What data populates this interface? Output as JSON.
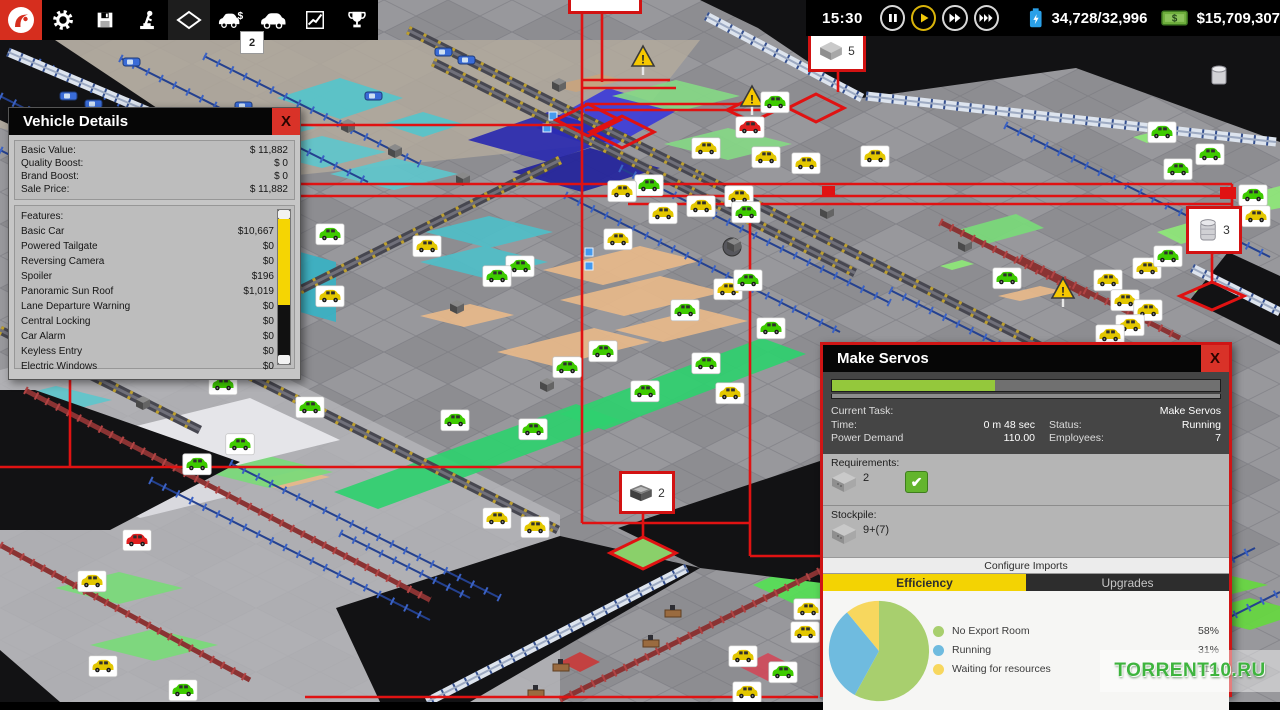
{
  "toolbar": {
    "icons": [
      "app-logo",
      "settings",
      "save",
      "research",
      "view-mode",
      "showroom",
      "vehicle-design",
      "stats",
      "achievements"
    ],
    "showroom_badge": "2",
    "time": "15:30",
    "resources": "34,728/32,996",
    "money": "$15,709,307"
  },
  "map": {
    "badge_counts": {
      "crate": "5",
      "barrel": "3",
      "machine": "2"
    },
    "zones": [
      {
        "p": "40,40 700,40 620,142 230,182 0,128 0,92",
        "c": "#b1a99c",
        "o": 0.85
      },
      {
        "p": "277,98 340,78 403,98 340,119",
        "c": "#55c4cb"
      },
      {
        "p": "383,124 423,112 463,124 423,137",
        "c": "#55c4cb"
      },
      {
        "p": "188,128 252,112 316,128 252,144",
        "c": "#5ec6cc"
      },
      {
        "p": "258,152 322,136 386,152 322,168",
        "c": "#5ec6cc"
      },
      {
        "p": "330,174 394,158 458,174 394,190",
        "c": "#5ec6cc"
      },
      {
        "p": "425,232 489,216 553,232 489,248",
        "c": "#4fbec8"
      },
      {
        "p": "420,262 484,246 548,262 484,278",
        "c": "#4fbec8"
      },
      {
        "p": "60,318 124,302 188,318 124,334",
        "c": "#5ec6cc"
      },
      {
        "p": "0,400 56,386 112,400 56,414",
        "c": "#5ec6cc"
      },
      {
        "p": "300,252 336,262 336,322 300,312",
        "c": "#38b2c4"
      },
      {
        "p": "536,128 608,88 678,110 606,150",
        "c": "#3c3cd8"
      },
      {
        "p": "468,140 548,112 628,134 548,162",
        "c": "#2a2ab0"
      },
      {
        "p": "512,172 590,148 660,168 582,192",
        "c": "#23239c"
      },
      {
        "p": "612,96 676,80 740,96 676,112",
        "c": "#86d886"
      },
      {
        "p": "664,144 728,128 792,144 728,160",
        "c": "#86d886"
      },
      {
        "p": "334,492 576,404 620,420 378,509",
        "c": "#2fd06f"
      },
      {
        "p": "560,414 762,338 806,354 604,430",
        "c": "#2fd06f"
      },
      {
        "p": "753,585 801,563 849,585 801,607",
        "c": "#55e055"
      },
      {
        "p": "543,270 640,246 700,261 603,285",
        "c": "#e7b98a"
      },
      {
        "p": "560,300 660,276 724,292 624,316",
        "c": "#e7b98a"
      },
      {
        "p": "497,352 594,328 650,342 553,366",
        "c": "#e7b98a"
      },
      {
        "p": "420,316 470,304 514,315 464,327",
        "c": "#e7b98a"
      },
      {
        "p": "615,330 700,309 748,321 663,342",
        "c": "#e7b98a"
      },
      {
        "p": "998,296 1040,286 1062,291 1020,301",
        "c": "#e7b98a"
      },
      {
        "p": "250,482 300,470 330,477 280,489",
        "c": "#e7b98a"
      },
      {
        "p": "552,86 600,74 624,80 576,92",
        "c": "#c8a47e"
      },
      {
        "p": "958,230 1016,214 1044,228 986,244",
        "c": "#7ada7a"
      },
      {
        "p": "1157,232 1205,218 1229,230 1181,244",
        "c": "#8ee878"
      },
      {
        "p": "1242,196 1280,186 1280,208 1258,212",
        "c": "#8ee878"
      },
      {
        "p": "1133,137 1161,130 1175,136 1147,143",
        "c": "#8ee878"
      },
      {
        "p": "940,266 962,260 974,264 952,270",
        "c": "#8ee878"
      },
      {
        "p": "1190,290 1240,272 1262,282 1212,300",
        "c": "#90ee60"
      },
      {
        "p": "1140,585 1204,569 1268,585 1204,601",
        "c": "#66d840"
      },
      {
        "p": "1186,614 1250,598 1280,606 1280,620 1250,630",
        "c": "#66d840"
      },
      {
        "p": "55,588 119,572 183,588 119,604",
        "c": "#7ada7a"
      },
      {
        "p": "90,645 154,629 218,645 154,661",
        "c": "#7ada7a"
      },
      {
        "p": "205,472 269,456 333,472 269,488",
        "c": "#7ada7a"
      },
      {
        "p": "120,430 250,398 340,440 210,472",
        "c": "#e9e9ee"
      },
      {
        "p": "60,484 150,462 230,496 140,518",
        "c": "#dcdce2"
      },
      {
        "p": "740,667 768,653 796,667 768,681",
        "c": "#cf4a5a"
      },
      {
        "p": "560,662 580,652 600,662 580,672",
        "c": "#c83b3b"
      }
    ],
    "darks": [
      "700,0 1280,0 1280,142 1076,68 862,98 758,28",
      "1228,252 1280,276 1280,345 1190,300",
      "336,608 560,536 700,568 470,702 380,702",
      "618,528 838,455 838,585 700,568",
      "0,390 35,390 240,462 110,530 0,530",
      "0,650 60,702 0,702",
      "0,40 55,40 160,110 60,148 0,120"
    ],
    "walls": [
      [
        687,
        568,
        427,
        702
      ],
      [
        866,
        96,
        1276,
        142
      ],
      [
        706,
        16,
        862,
        98
      ],
      [
        1192,
        268,
        1280,
        312
      ],
      [
        8,
        52,
        150,
        112
      ]
    ],
    "fences": [
      [
        38,
        62,
        286,
        186
      ],
      [
        120,
        58,
        368,
        182
      ],
      [
        204,
        56,
        420,
        164
      ],
      [
        0,
        150,
        180,
        240
      ],
      [
        0,
        96,
        120,
        156
      ],
      [
        565,
        195,
        840,
        332
      ],
      [
        620,
        168,
        890,
        303
      ],
      [
        150,
        480,
        430,
        620
      ],
      [
        230,
        463,
        500,
        598
      ],
      [
        845,
        690,
        1125,
        550
      ],
      [
        950,
        700,
        1255,
        548
      ],
      [
        1060,
        702,
        1280,
        592
      ],
      [
        890,
        290,
        1140,
        415
      ],
      [
        1005,
        125,
        1270,
        257
      ],
      [
        340,
        533,
        470,
        598
      ]
    ],
    "convs": [
      [
        408,
        30,
        700,
        176
      ],
      [
        700,
        176,
        1060,
        356
      ],
      [
        208,
        355,
        558,
        530
      ],
      [
        560,
        160,
        300,
        290
      ],
      [
        0,
        330,
        200,
        430
      ],
      [
        433,
        62,
        855,
        273
      ]
    ],
    "maroons": [
      [
        25,
        390,
        430,
        600
      ],
      [
        0,
        545,
        250,
        680
      ],
      [
        560,
        700,
        838,
        562
      ],
      [
        860,
        700,
        1150,
        555
      ],
      [
        940,
        222,
        1090,
        297
      ],
      [
        1020,
        258,
        1180,
        338
      ]
    ],
    "red_lines": [
      [
        582,
        8,
        582,
        523
      ],
      [
        602,
        3,
        602,
        82
      ],
      [
        582,
        80,
        670,
        80
      ],
      [
        582,
        88,
        676,
        88
      ],
      [
        585,
        104,
        786,
        104
      ],
      [
        585,
        110,
        786,
        110
      ],
      [
        70,
        184,
        1232,
        184
      ],
      [
        70,
        196,
        628,
        196
      ],
      [
        628,
        196,
        1232,
        196
      ],
      [
        628,
        204,
        1232,
        204
      ],
      [
        300,
        125,
        582,
        125
      ],
      [
        70,
        125,
        70,
        467
      ],
      [
        0,
        467,
        582,
        467
      ],
      [
        750,
        204,
        750,
        556
      ],
      [
        750,
        556,
        820,
        556
      ],
      [
        1232,
        184,
        1232,
        209
      ],
      [
        838,
        66,
        838,
        92
      ],
      [
        643,
        508,
        643,
        538
      ],
      [
        1212,
        247,
        1212,
        284
      ],
      [
        582,
        523,
        750,
        523
      ],
      [
        305,
        697,
        818,
        697
      ]
    ],
    "red_diamonds": [
      {
        "p": "788,108 816,94 844,108 816,122"
      },
      {
        "p": "727,110 752,98 777,110 752,122"
      },
      {
        "p": "1180,296 1212,282 1244,296 1212,310"
      },
      {
        "p": "610,553 643,537 676,553 643,569",
        "f": "#8ad06a"
      },
      {
        "p": "556,120 588,104 620,120 588,136"
      },
      {
        "p": "590,132 622,116 654,132 622,148"
      }
    ],
    "red_boxes": [
      [
        1220,
        187,
        16,
        12
      ],
      [
        822,
        186,
        13,
        10
      ]
    ],
    "badges": [
      [
        750,
        128,
        "r"
      ],
      [
        706,
        149,
        "y"
      ],
      [
        775,
        103,
        "g"
      ],
      [
        766,
        158,
        "y"
      ],
      [
        806,
        164,
        "y"
      ],
      [
        875,
        157,
        "y"
      ],
      [
        649,
        186,
        "g"
      ],
      [
        622,
        192,
        "y"
      ],
      [
        663,
        214,
        "y"
      ],
      [
        701,
        207,
        "y"
      ],
      [
        739,
        197,
        "y"
      ],
      [
        618,
        240,
        "y"
      ],
      [
        427,
        247,
        "y"
      ],
      [
        520,
        267,
        "g"
      ],
      [
        497,
        277,
        "g"
      ],
      [
        567,
        368,
        "g"
      ],
      [
        603,
        352,
        "g"
      ],
      [
        645,
        392,
        "g"
      ],
      [
        685,
        311,
        "g"
      ],
      [
        728,
        290,
        "y"
      ],
      [
        748,
        281,
        "g"
      ],
      [
        771,
        329,
        "g"
      ],
      [
        730,
        394,
        "y"
      ],
      [
        706,
        364,
        "g"
      ],
      [
        746,
        213,
        "g"
      ],
      [
        533,
        430,
        "g"
      ],
      [
        455,
        421,
        "g"
      ],
      [
        1162,
        133,
        "g"
      ],
      [
        1210,
        155,
        "g"
      ],
      [
        1178,
        170,
        "g"
      ],
      [
        1253,
        196,
        "g"
      ],
      [
        1256,
        217,
        "y"
      ],
      [
        1108,
        281,
        "y"
      ],
      [
        1147,
        269,
        "y"
      ],
      [
        1168,
        257,
        "g"
      ],
      [
        1125,
        301,
        "y"
      ],
      [
        1148,
        311,
        "y"
      ],
      [
        1130,
        326,
        "y"
      ],
      [
        1110,
        336,
        "y"
      ],
      [
        1007,
        279,
        "g"
      ],
      [
        223,
        385,
        "g"
      ],
      [
        310,
        408,
        "g"
      ],
      [
        240,
        445,
        "g"
      ],
      [
        197,
        465,
        "g"
      ],
      [
        330,
        235,
        "g"
      ],
      [
        330,
        297,
        "y"
      ],
      [
        92,
        582,
        "y"
      ],
      [
        137,
        541,
        "r"
      ],
      [
        103,
        667,
        "y"
      ],
      [
        183,
        691,
        "g"
      ],
      [
        497,
        519,
        "y"
      ],
      [
        535,
        528,
        "y"
      ],
      [
        747,
        693,
        "y"
      ],
      [
        743,
        657,
        "y"
      ],
      [
        783,
        673,
        "g"
      ],
      [
        808,
        610,
        "y"
      ],
      [
        805,
        633,
        "y"
      ]
    ],
    "machines": [
      [
        341,
        119
      ],
      [
        388,
        144
      ],
      [
        456,
        172
      ],
      [
        540,
        378
      ],
      [
        450,
        300
      ],
      [
        727,
        238
      ],
      [
        136,
        396
      ],
      [
        820,
        205
      ],
      [
        958,
        238
      ],
      [
        552,
        78
      ]
    ],
    "cars": [
      [
        123,
        58
      ],
      [
        60,
        92
      ],
      [
        85,
        100
      ],
      [
        235,
        102
      ],
      [
        365,
        92
      ],
      [
        435,
        48
      ],
      [
        458,
        56
      ]
    ],
    "desks": [
      [
        665,
        610
      ],
      [
        643,
        640
      ],
      [
        553,
        664
      ],
      [
        528,
        690
      ]
    ],
    "triangles": [
      [
        643,
        48
      ],
      [
        752,
        88
      ],
      [
        1063,
        280
      ]
    ],
    "barrels": [
      [
        1219,
        69
      ]
    ],
    "chips": [
      [
        549,
        112
      ],
      [
        543,
        124
      ],
      [
        585,
        248
      ],
      [
        585,
        262
      ]
    ],
    "discs": [
      [
        732,
        247,
        9
      ]
    ]
  },
  "vehicle_details": {
    "title": "Vehicle Details",
    "close": "X",
    "stats": [
      {
        "n": "Basic Value:",
        "v": "$ 11,882"
      },
      {
        "n": "Quality Boost:",
        "v": "$ 0"
      },
      {
        "n": "Brand Boost:",
        "v": "$ 0"
      },
      {
        "n": "Sale Price:",
        "v": "$ 11,882"
      }
    ],
    "features_label": "Features:",
    "features": [
      {
        "n": "Basic Car",
        "v": "$10,667"
      },
      {
        "n": "Powered Tailgate",
        "v": "$0"
      },
      {
        "n": "Reversing Camera",
        "v": "$0"
      },
      {
        "n": "Spoiler",
        "v": "$196"
      },
      {
        "n": "Panoramic Sun Roof",
        "v": "$1,019"
      },
      {
        "n": "Lane Departure Warning",
        "v": "$0"
      },
      {
        "n": "Central Locking",
        "v": "$0"
      },
      {
        "n": "Car Alarm",
        "v": "$0"
      },
      {
        "n": "Keyless Entry",
        "v": "$0"
      },
      {
        "n": "Electric Windows",
        "v": "$0"
      }
    ]
  },
  "make_servos": {
    "title": "Make Servos",
    "close": "X",
    "progress_pct": 42,
    "current_task_label": "Current Task:",
    "current_task_value": "Make Servos",
    "time_label": "Time:",
    "time_value": "0 m 48 sec",
    "status_label": "Status:",
    "status_value": "Running",
    "power_label": "Power Demand",
    "power_value": "110.00",
    "employees_label": "Employees:",
    "employees_value": "7",
    "requirements_label": "Requirements:",
    "req_count": "2",
    "stockpile_label": "Stockpile:",
    "stock_count": "9+(7)",
    "configure_label": "Configure Imports",
    "tabs": [
      "Efficiency",
      "Upgrades"
    ]
  },
  "chart_data": {
    "type": "pie",
    "labels": [
      "No Export Room",
      "Running",
      "Waiting for resources"
    ],
    "values": [
      58,
      31,
      11
    ],
    "pct_labels": [
      "58%",
      "31%",
      "11%"
    ],
    "colors": [
      "#a8cf6e",
      "#6fbbdf",
      "#f7d75e"
    ],
    "legend_position": "right"
  },
  "watermark": {
    "text": "TORRENT10.RU"
  }
}
